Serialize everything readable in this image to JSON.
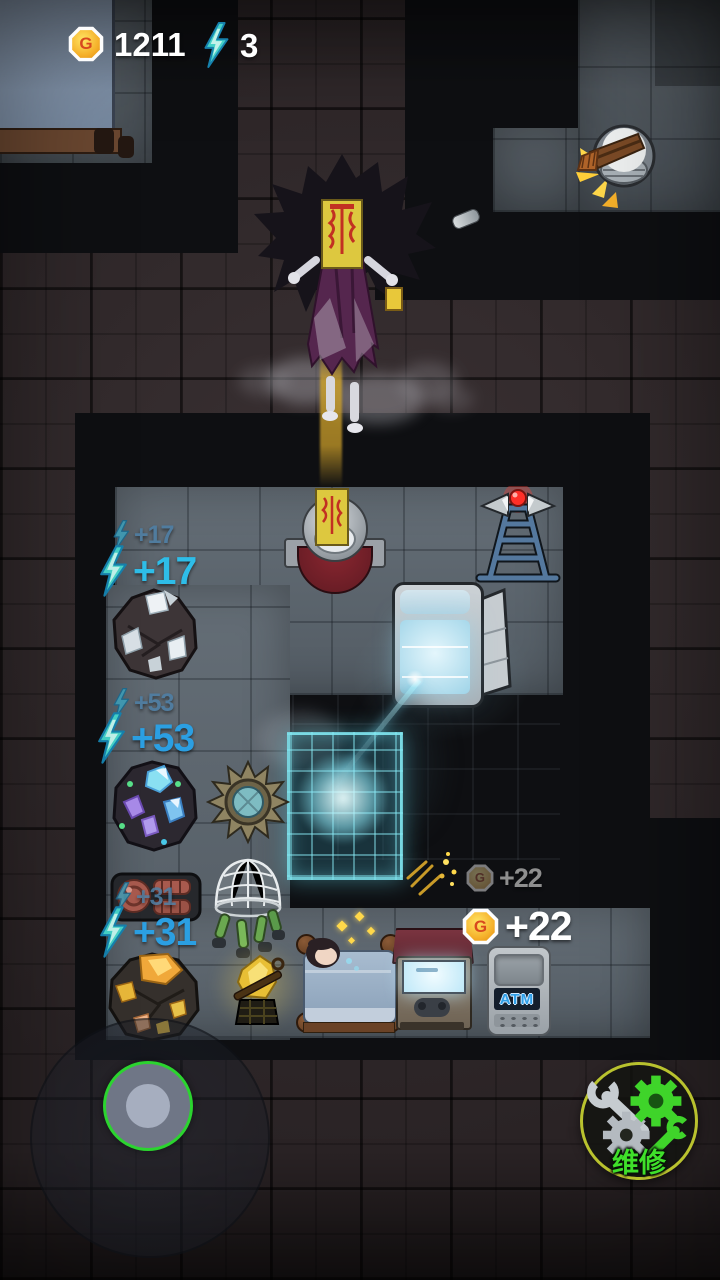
{
  "hud": {
    "coin_letter": "G",
    "coin_count": "1211",
    "energy_count": "3"
  },
  "floating_rewards": {
    "energy_17_faded": "+17",
    "energy_17": "+17",
    "energy_53_faded": "+53",
    "energy_53": "+53",
    "energy_31_faded": "+31",
    "energy_31": "+31",
    "coin_22_faded": "+22",
    "coin_22": "+22"
  },
  "machines": {
    "atm_label": "ATM"
  },
  "controls": {
    "repair_button_label": "维修"
  },
  "colors": {
    "energy_text": "#2fb3ec",
    "energy_text_faded": "#4f7fa4",
    "coin_gain_text": "#ffffff",
    "coin_gain_text_faded": "#9c9c9c",
    "repair_label": "#3fe02a",
    "repair_ring": "#b9c22e",
    "joystick_ring": "#2bd42f",
    "laser_beam": "#9fe8ff",
    "coin_gold": "#f5b02a",
    "alarm_light": "#ff3a30"
  }
}
